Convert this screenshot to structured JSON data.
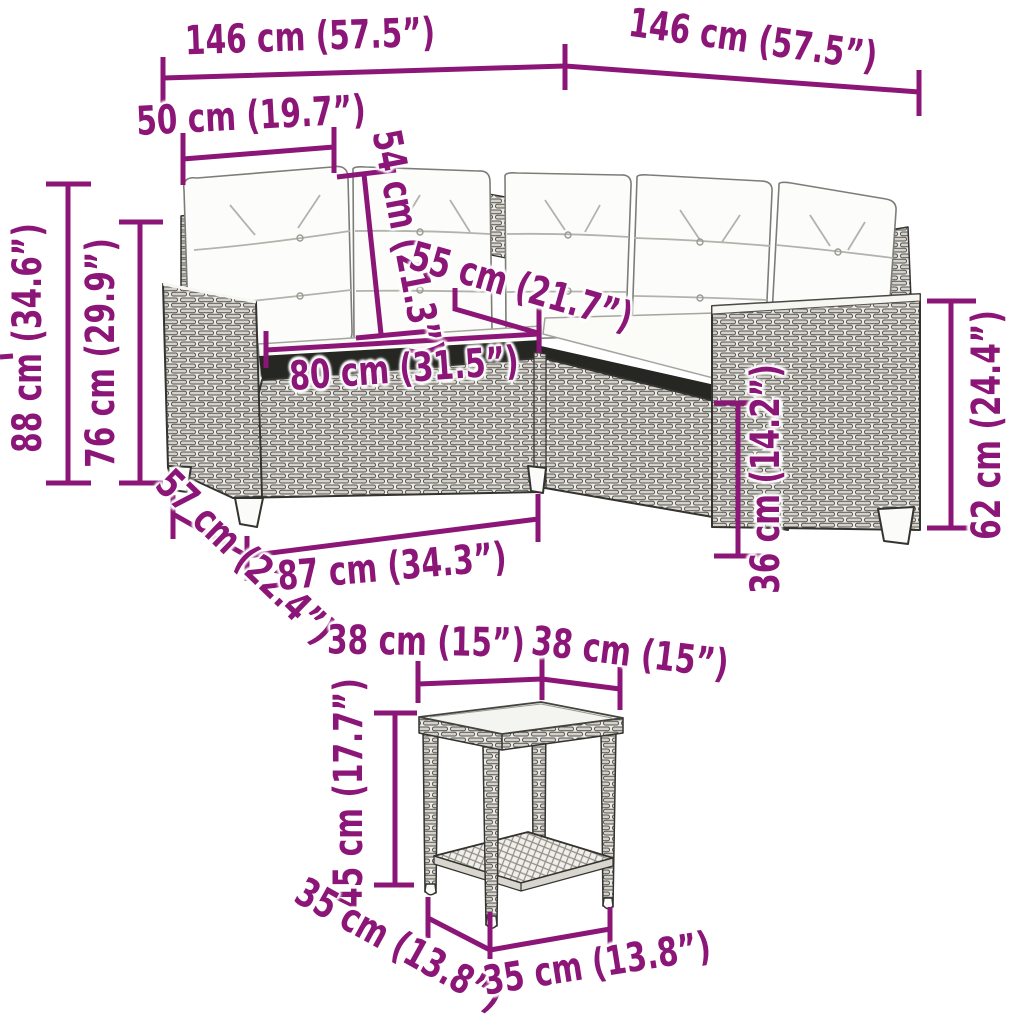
{
  "figure": {
    "kind": "product-dimension-diagram",
    "subject": "L-shaped poly rattan garden sofa with white tufted cushions and square side table with lower shelf",
    "style": "black line drawing with rattan weave texture",
    "accent_color": "#8C1677",
    "background_color": "#FFFFFF"
  },
  "dims": {
    "w_left": "146 cm (57.5”)",
    "w_right": "146 cm (57.5”)",
    "cushion_w": "50 cm (19.7”)",
    "back_cushion_h": "54 cm (21.3”)",
    "seat_depth": "55 cm (21.7”)",
    "seat_w": "80 cm (31.5”)",
    "total_h": "88 cm (34.6”)",
    "back_h": "76 cm (29.9”)",
    "side_depth": "57 cm (22.4”)",
    "base_w": "87 cm (34.3”)",
    "arm_h": "62 cm (24.4”)",
    "seat_h": "36 cm (14.2”)",
    "table_w_left": "38 cm (15”)",
    "table_w_right": "38 cm (15”)",
    "table_h": "45 cm (17.7”)",
    "table_base_left": "35 cm (13.8”)",
    "table_base_right": "35 cm (13.8”)"
  }
}
